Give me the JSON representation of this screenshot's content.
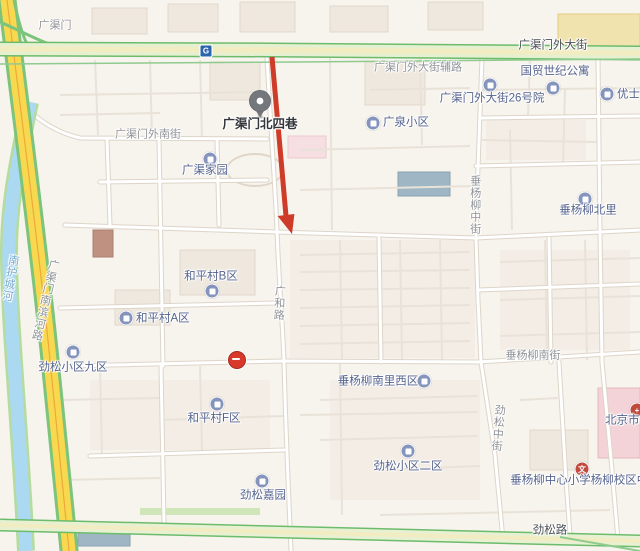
{
  "app": {
    "type": "map-screenshot",
    "area": "北京 广渠门 / 劲松"
  },
  "colors": {
    "background": "#f7f3ed",
    "major_road_green": "#6cbc6c",
    "major_road_fill": "#e4f0cf",
    "expressway_yellow": "#f8d84e",
    "river_blue": "#abd9f2",
    "annotation_arrow_red": "#ce3b28",
    "poi_icon_blue": "#8594bc",
    "pin_gray": "#74777c",
    "no_entry_red": "#d8392b",
    "subway_blue": "#2a63ae"
  },
  "road_labels": [
    {
      "text": "广渠门",
      "orientation": "horizontal"
    },
    {
      "text": "广渠门外大街",
      "orientation": "horizontal"
    },
    {
      "text": "广渠门外大街辅路",
      "orientation": "horizontal"
    },
    {
      "text": "广渠门外南街",
      "orientation": "horizontal"
    },
    {
      "text": "垂杨柳南街",
      "orientation": "horizontal"
    },
    {
      "text": "劲松路",
      "orientation": "horizontal"
    },
    {
      "text": "广渠门南滨河路",
      "orientation": "vertical"
    },
    {
      "text": "南护城河",
      "orientation": "vertical"
    },
    {
      "text": "广和路",
      "orientation": "vertical"
    },
    {
      "text": "垂杨柳中街",
      "orientation": "vertical"
    },
    {
      "text": "劲松中街",
      "orientation": "vertical"
    }
  ],
  "pois": [
    {
      "text": "广渠门北四巷",
      "kind": "pinned-place"
    },
    {
      "text": "广渠家园",
      "kind": "residential"
    },
    {
      "text": "广泉小区",
      "kind": "residential"
    },
    {
      "text": "广渠门外大街26号院",
      "kind": "residential"
    },
    {
      "text": "国贸世纪公寓",
      "kind": "residential"
    },
    {
      "text": "优士阁",
      "kind": "residential"
    },
    {
      "text": "垂杨柳北里",
      "kind": "residential"
    },
    {
      "text": "和平村B区",
      "kind": "residential"
    },
    {
      "text": "和平村A区",
      "kind": "residential"
    },
    {
      "text": "劲松小区九区",
      "kind": "residential"
    },
    {
      "text": "垂杨柳南里西区",
      "kind": "residential"
    },
    {
      "text": "和平村F区",
      "kind": "residential"
    },
    {
      "text": "劲松小区二区",
      "kind": "residential"
    },
    {
      "text": "劲松嘉园",
      "kind": "residential"
    },
    {
      "text": "垂杨柳中心小学杨柳校区中部",
      "kind": "school"
    },
    {
      "text": "北京市垂",
      "kind": "hospital-clipped"
    }
  ],
  "markers": {
    "subway_glyph": "G",
    "school_glyph": "文",
    "hospital_glyph": "+"
  }
}
